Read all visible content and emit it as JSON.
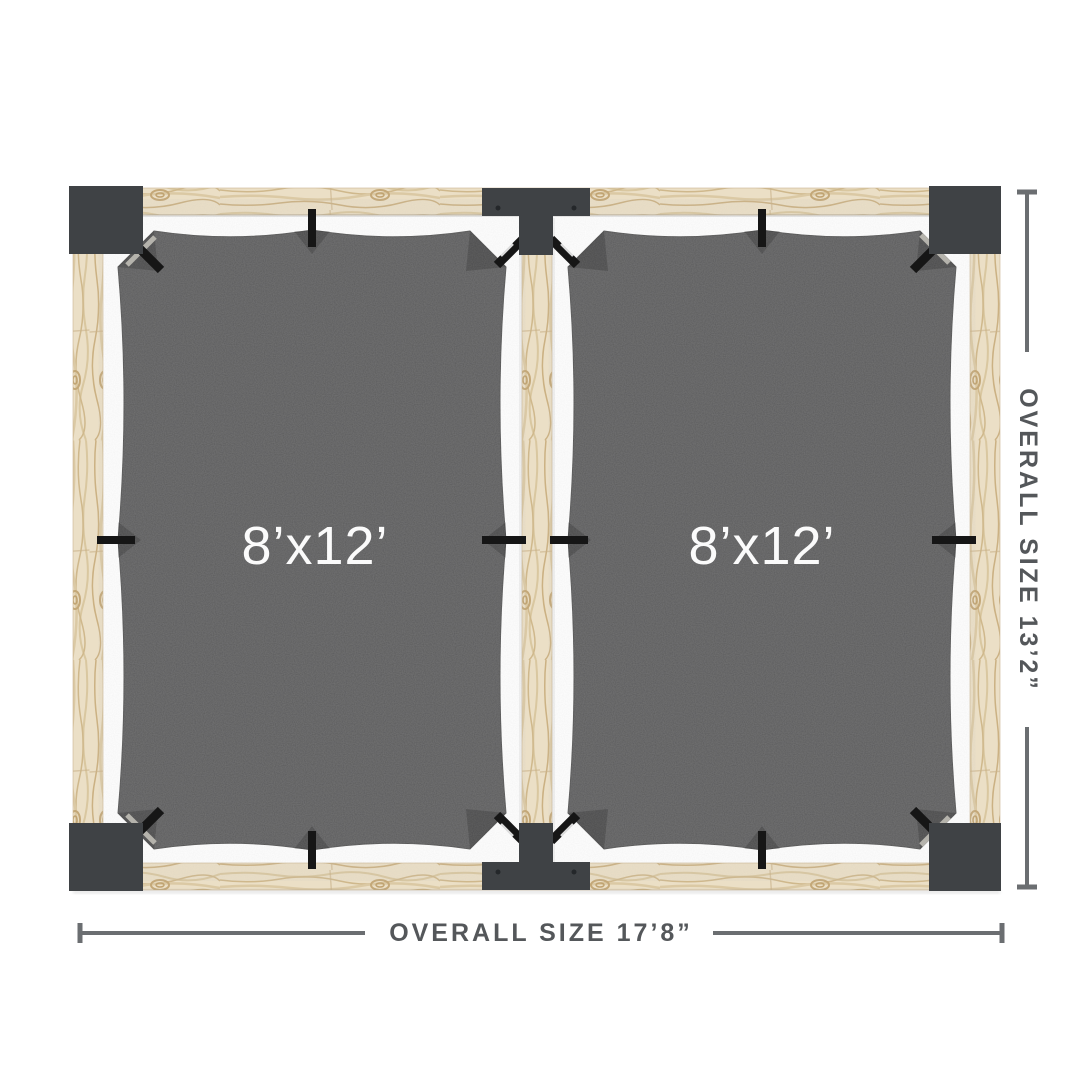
{
  "panels": [
    {
      "label": "8’x12’"
    },
    {
      "label": "8’x12’"
    }
  ],
  "dimensions": {
    "overall_width_label": "OVERALL SIZE 17’8”",
    "overall_height_label": "OVERALL SIZE 13’2”"
  },
  "colors": {
    "background": "#ffffff",
    "wood": "#ebdfc6",
    "wood_grain": "#d3bd95",
    "bracket": "#3f4245",
    "hardware": "#161616",
    "fabric": "#5a5a5b",
    "panel_label": "#fbfbfb",
    "dimension_text": "#54575a",
    "dimension_line": "#6b6e71"
  }
}
